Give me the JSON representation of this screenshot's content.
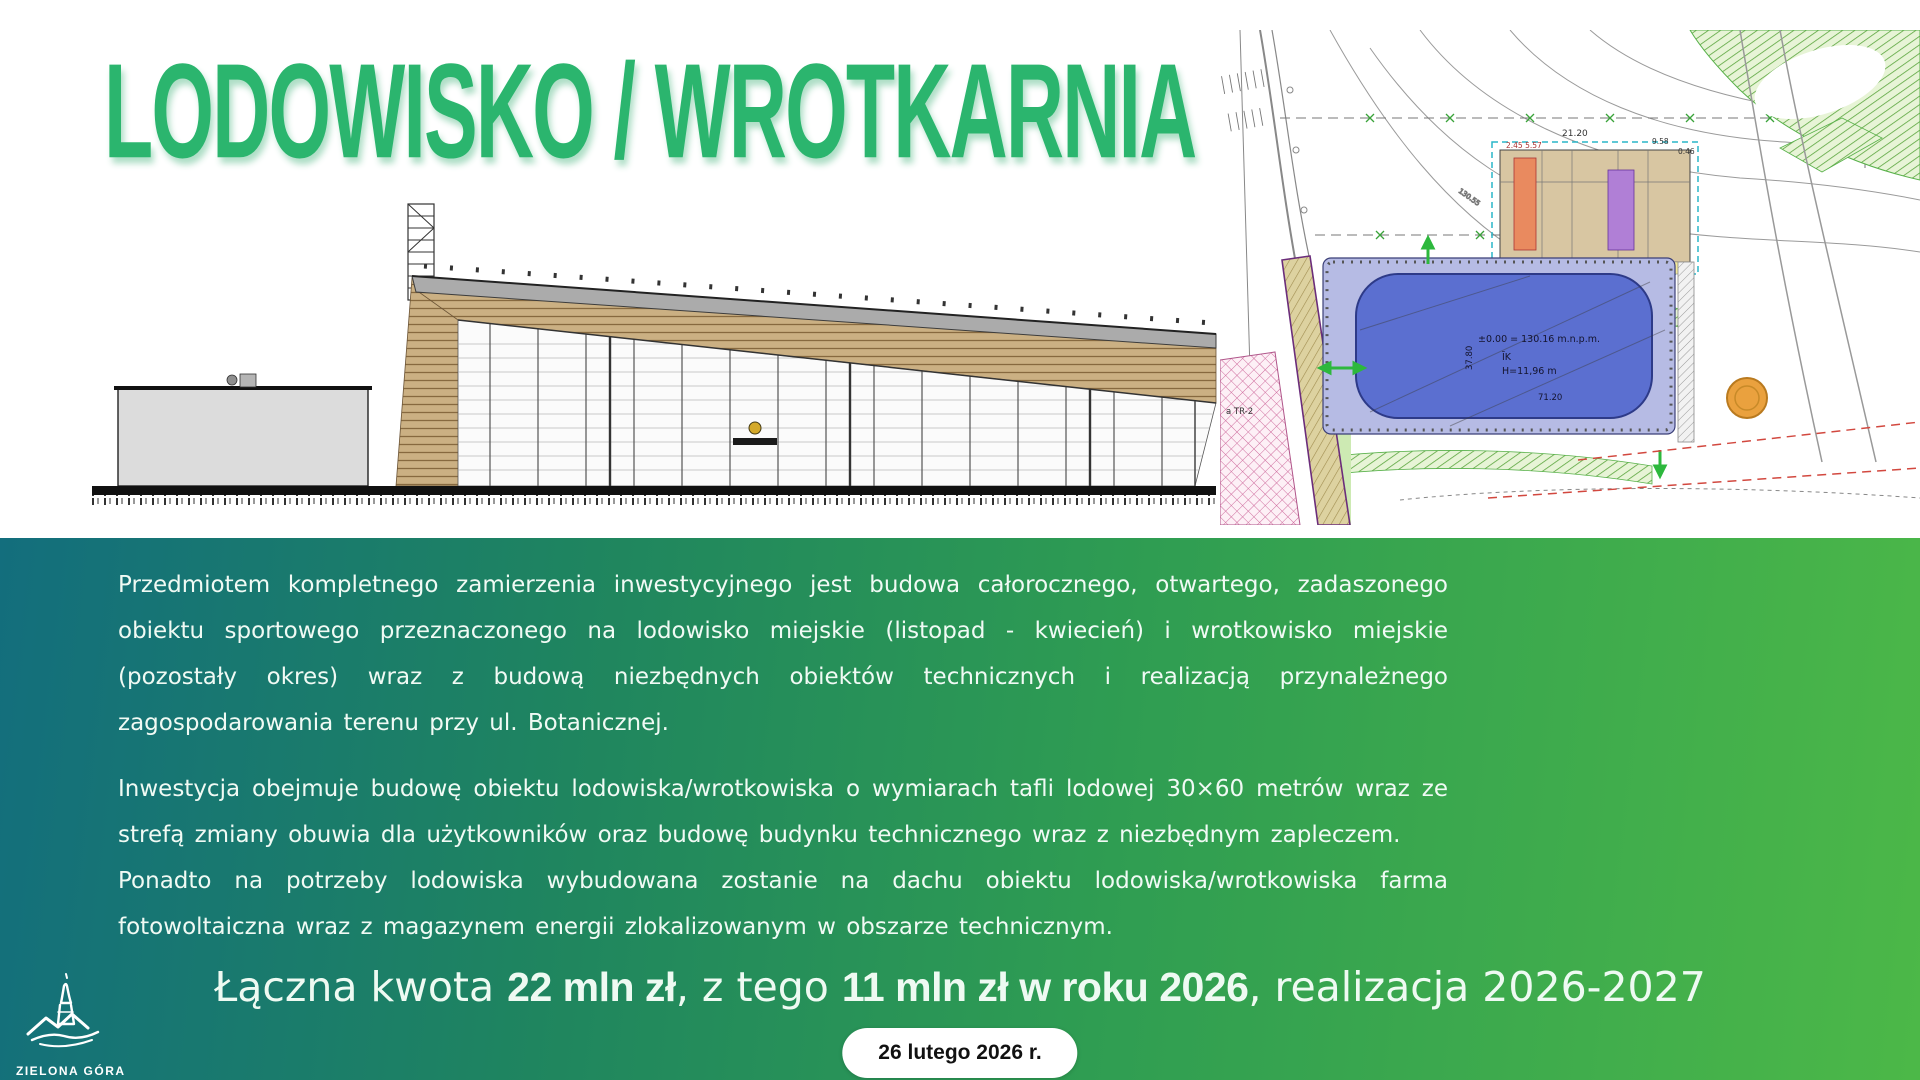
{
  "slide": {
    "title": "LODOWISKO / WROTKARNIA",
    "paragraph1": "Przedmiotem kompletnego zamierzenia inwestycyjnego jest budowa całorocznego, otwartego, zadaszonego obiektu sportowego przeznaczonego na lodowisko miejskie (listopad - kwiecień) i wrotkowisko miejskie (pozostały okres) wraz z budową niezbędnych obiektów technicznych i realizacją przynależnego zagospodarowania terenu przy ul. Botanicznej.",
    "paragraph2": "Inwestycja obejmuje budowę obiektu lodowiska/wrotkowiska o wymiarach tafli lodowej 30×60 metrów wraz ze strefą zmiany obuwia dla użytkowników oraz budowę budynku technicznego wraz z niezbędnym zapleczem.",
    "paragraph3": "Ponadto na potrzeby lodowiska wybudowana zostanie na dachu obiektu lodowiska/wrotkowiska farma fotowoltaiczna wraz z magazynem energii zlokalizowanym w obszarze technicznym.",
    "summary": {
      "prefix": "Łączna kwota ",
      "amount_total": "22 mln zł",
      "middle": ", z tego ",
      "amount_2026": "11 mln zł w roku 2026",
      "suffix": ", realizacja 2026-2027"
    },
    "date_badge": "26 lutego 2026 r.",
    "logo": {
      "city": "ZIELONA GÓRA"
    },
    "site_plan_labels": {
      "level": "±0.00 = 130.16 m.n.p.m.",
      "ik": "ĪK",
      "height": "H=11,96 m",
      "length": "71.20",
      "width": "37.80",
      "dim_a": "21.20",
      "dim_b": "2.45 5.57",
      "dim_c": "9.58",
      "dim_d": "0.46",
      "tr": "a TR-2"
    },
    "colors": {
      "title_green": "#2bb56e",
      "gradient_left": "#136e7d",
      "gradient_right": "#4cb848",
      "rink_fill": "#5b6fd0",
      "rink_platform": "#b6bbe4",
      "badge_bg": "#ffffff",
      "badge_text": "#111111"
    }
  }
}
